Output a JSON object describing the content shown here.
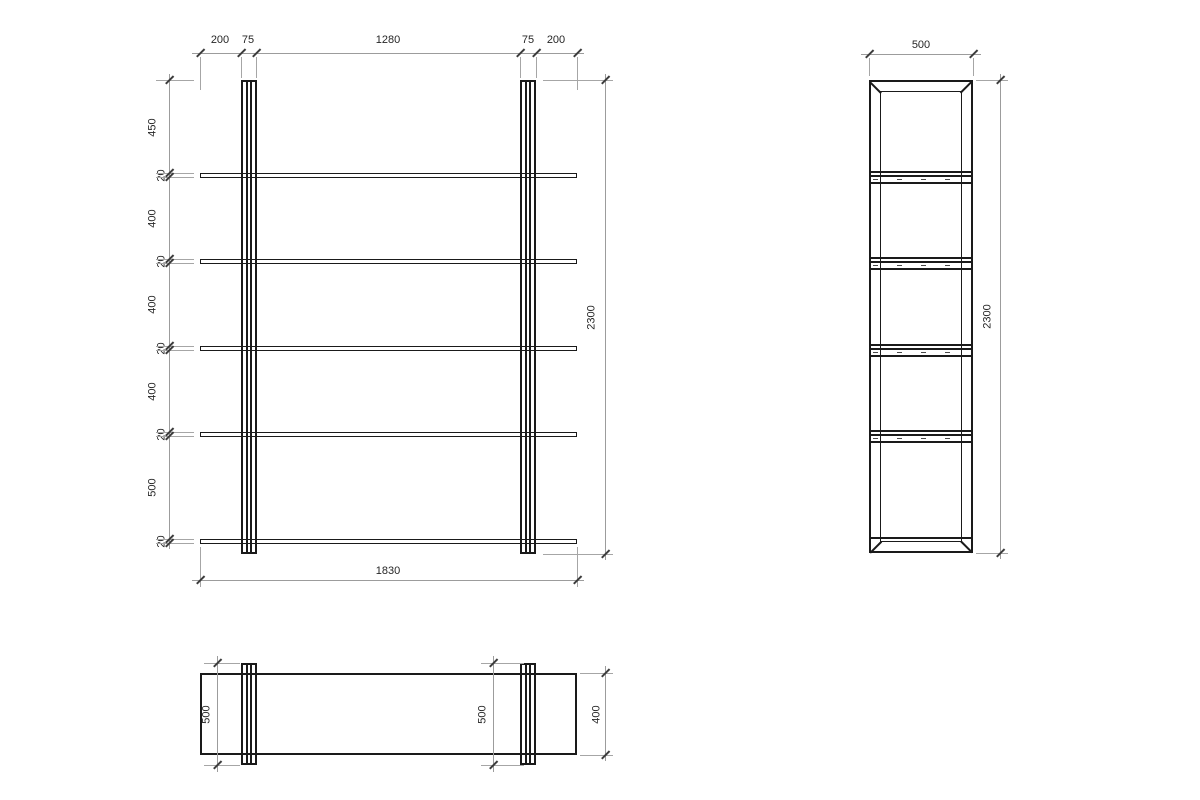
{
  "front_view": {
    "top_dims": [
      "200",
      "75",
      "1280",
      "75",
      "200"
    ],
    "left_dims": [
      "450",
      "20",
      "400",
      "20",
      "400",
      "20",
      "400",
      "20",
      "500",
      "20"
    ],
    "height_dim": "2300",
    "width_dim": "1830"
  },
  "side_view": {
    "width_dim": "500",
    "height_dim": "2300"
  },
  "plan_view": {
    "post_depth_dims": [
      "500",
      "500"
    ],
    "shelf_depth_dim": "400"
  }
}
